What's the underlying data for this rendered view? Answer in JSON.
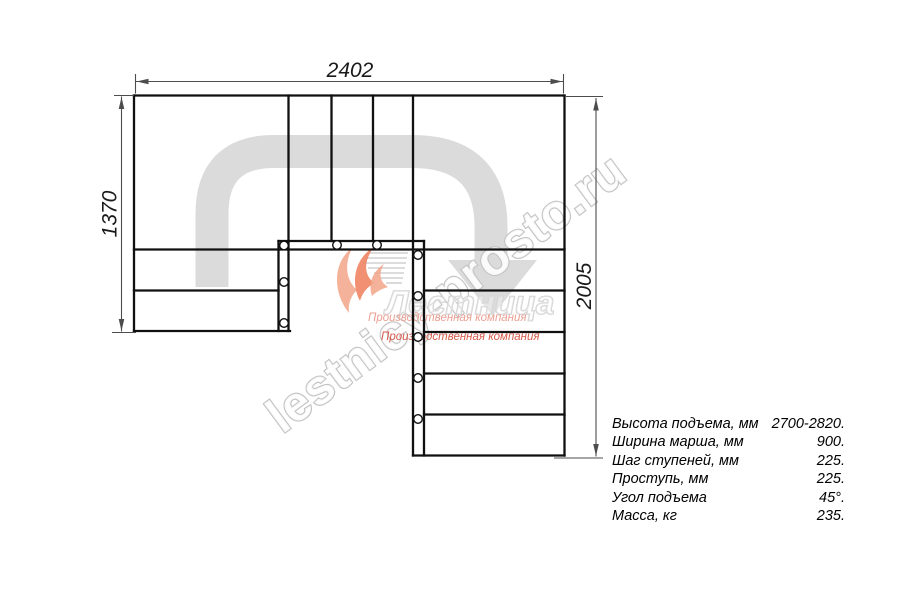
{
  "drawing_title": "U-shaped staircase plan",
  "dimensions": {
    "top_width": "2402",
    "left_height": "1370",
    "right_height": "2005"
  },
  "specs": {
    "rows": [
      {
        "label": "Высота подъема, мм",
        "value": "2700-2820."
      },
      {
        "label": "Ширина марша, мм",
        "value": "900."
      },
      {
        "label": "Шаг ступеней, мм",
        "value": "225."
      },
      {
        "label": "Проступь, мм",
        "value": "225."
      },
      {
        "label": "Угол подъема",
        "value": "45°."
      },
      {
        "label": "Масса, кг",
        "value": "235."
      }
    ]
  },
  "watermark": {
    "site": "lestnicy-prosto.ru",
    "logo_text": "Лестница",
    "company_line1": "Производственная компания",
    "company_line2": "Производственная компания"
  },
  "colors": {
    "plan_line": "#101010",
    "dim_line": "#4d4d4d",
    "walkline_gray": "#dbdbdb",
    "wm_stroke": "#c3c3c3",
    "logo_orange_light": "#f2a488",
    "logo_orange": "#ee7d5b",
    "logo_red_text": "#d55a4b",
    "logo_red_text_faded": "#eaa093"
  }
}
